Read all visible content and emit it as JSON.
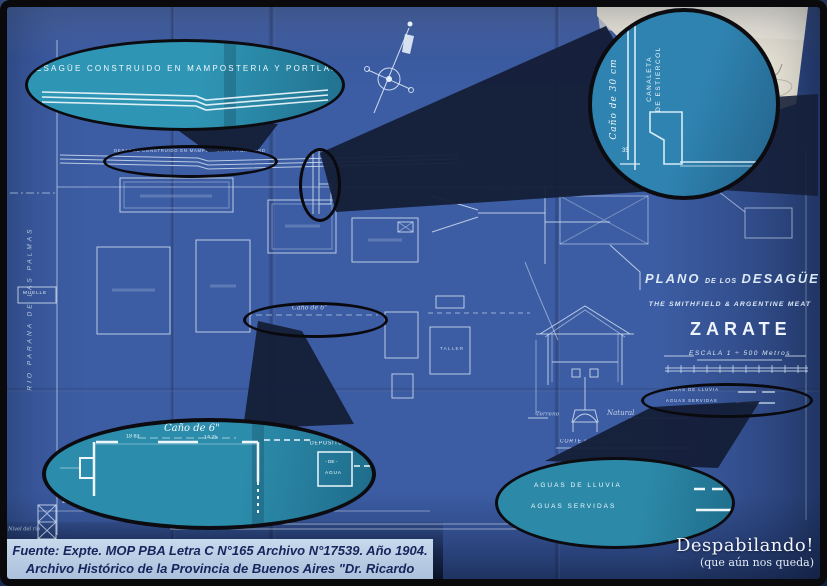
{
  "photo": {
    "frame_color": "#0a0a0c",
    "blueprint_color": "#3c5ca3",
    "callout_fill": "#2b8dac",
    "beam_color": "#151f39"
  },
  "callouts": {
    "top_left": {
      "note": "DESAGÜE  CONSTRUIDO  EN  MAMPOSTERIA  Y  PORTLAND"
    },
    "top_right": {
      "pipe_name": "Caño de 30 cm",
      "channel_line1": "CANALETA",
      "channel_line2": "DE ESTIERCOL",
      "dim": "35"
    },
    "bottom_left": {
      "pipe_name": "Caño de 6\"",
      "dim1": "18 83",
      "dim2": "14 25",
      "tank_title": "DEPOSITO",
      "tank_mid": "- DE -",
      "tank_bottom": "AGUA"
    },
    "bottom_right": {
      "legend_rain": "AGUAS  DE  LLUVIA",
      "legend_sewage": "AGUAS   SERVIDAS"
    }
  },
  "plan": {
    "tiny_note": "DESAGÜE CONSTRUIDO EN MAMPOSTERIA Y PORTLAND",
    "tiny_pipe": "Caño de 6\"",
    "river": "RIO PARANA DE LAS PALMAS",
    "muelle": "MUELLE",
    "darsena": "Dársena",
    "nivel": "Nivel del río",
    "corrales": "CORRALES",
    "taller": "TALLER",
    "legend_rain": "AGUAS DE LLUVIA",
    "legend_sewage": "AGUAS SERVIDAS",
    "corte": "CORTE  EF   Escala 1:50",
    "terreno": "Terreno",
    "natural": "Natural"
  },
  "titleblock": {
    "plano": "PLANO",
    "de_los": "DE LOS",
    "desagues": "DESAGÜES",
    "company": "THE  SMITHFIELD  &  ARGENTINE  MEAT",
    "city": "ZARATE",
    "escala": "ESCALA    1 ÷ 500 Metros"
  },
  "caption": {
    "line1": "Fuente: Expte. MOP PBA Letra C N°165 Archivo N°17539. Año 1904.",
    "line2": "Archivo Histórico de la Provincia de Buenos Aires \"Dr. Ricardo Levene\""
  },
  "watermark": {
    "title": "Despabilando!",
    "subtitle": "(que aún nos queda)"
  }
}
